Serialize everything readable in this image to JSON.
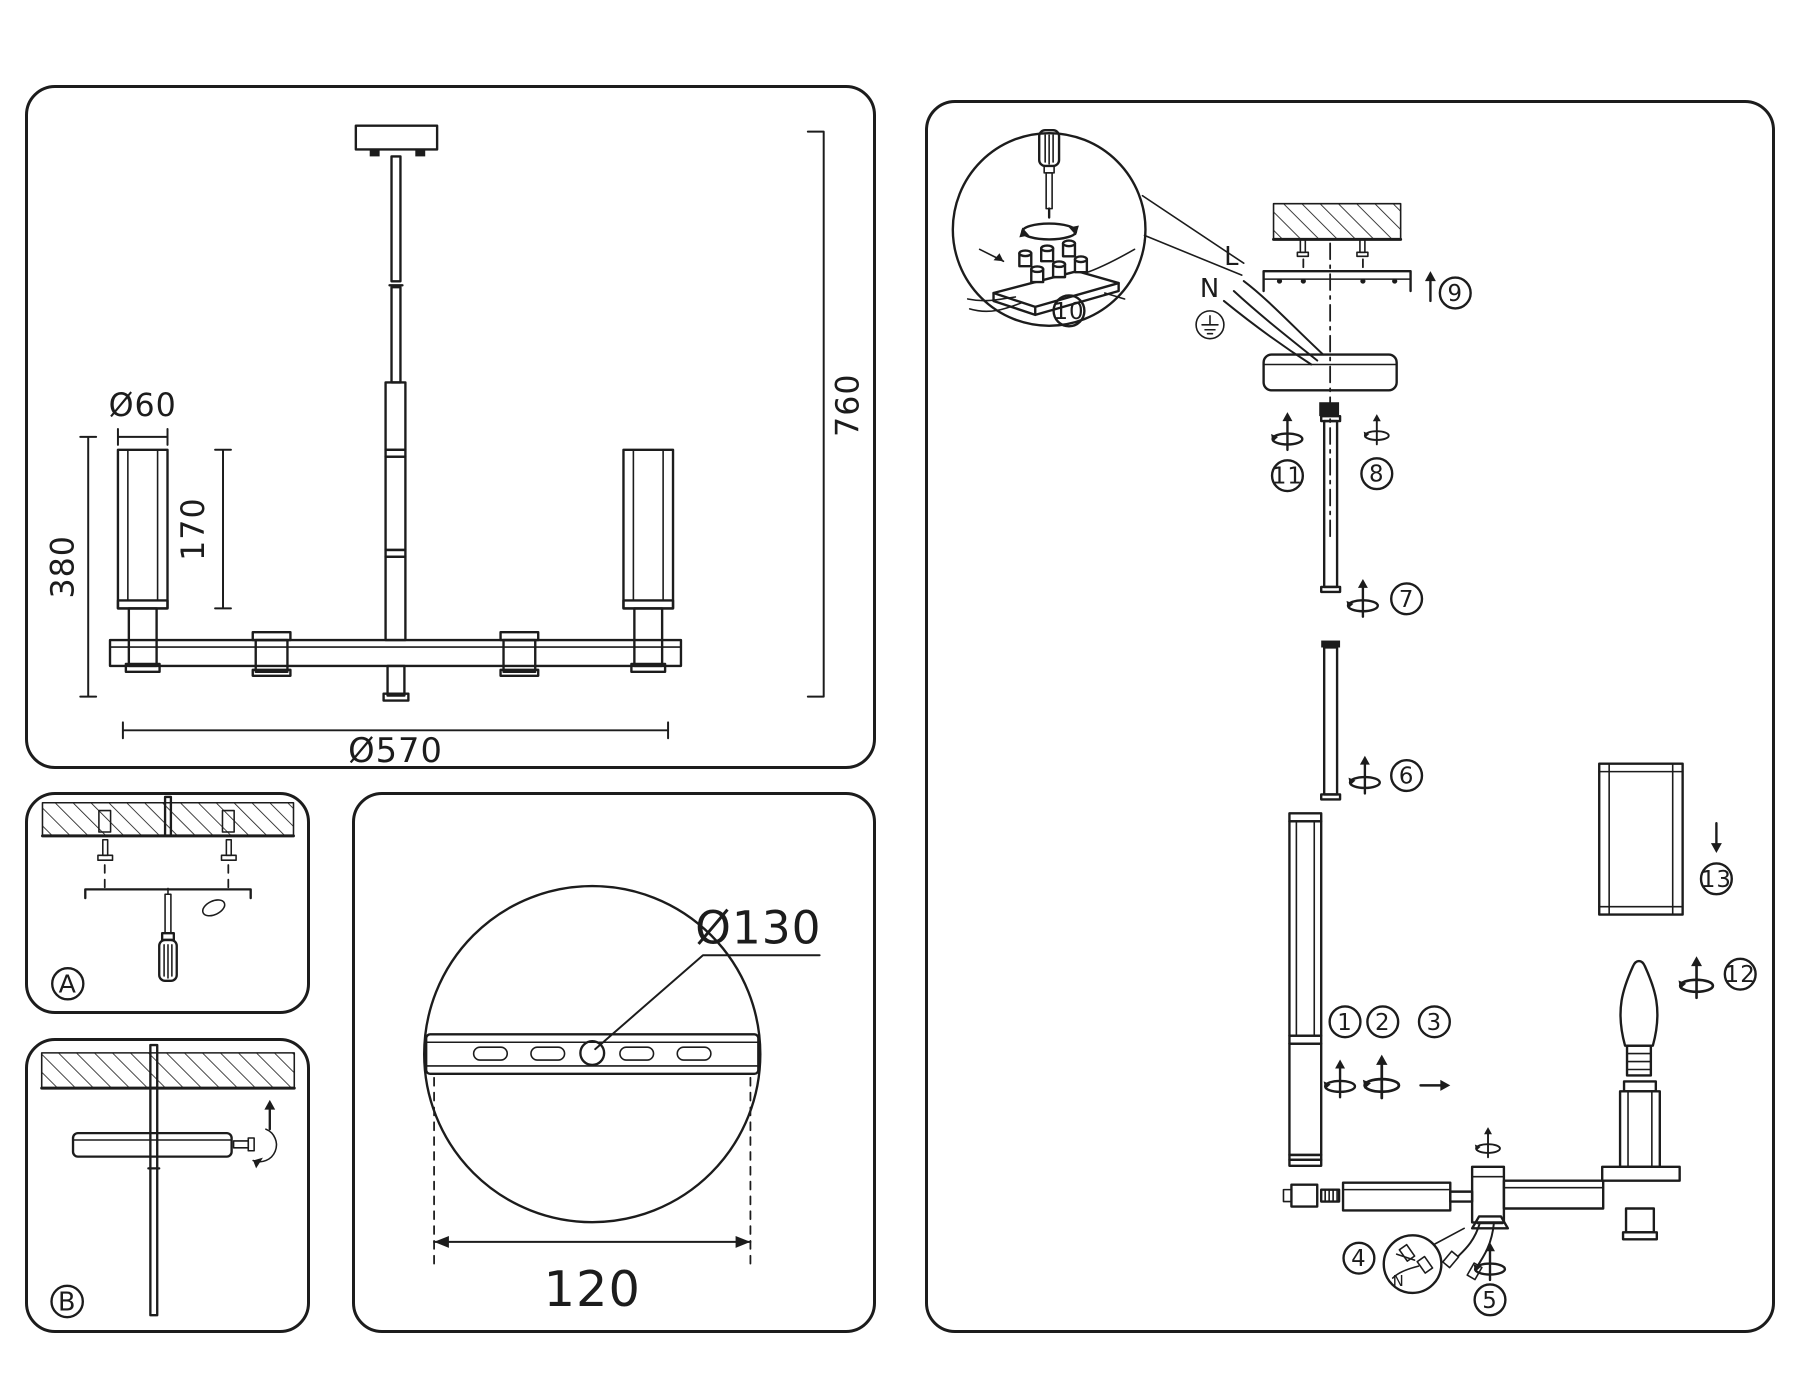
{
  "doc": {
    "background": "#ffffff",
    "line_color": "#1c1c1c"
  },
  "dims_panel": {
    "shade_diameter": "Ø60",
    "body_height": "380",
    "shade_height": "170",
    "total_drop": "760",
    "fixture_diameter": "Ø570"
  },
  "canopy_panel": {
    "plate_diameter": "Ø130",
    "hole_spacing": "120"
  },
  "step_panels": {
    "a_label": "A",
    "b_label": "B"
  },
  "assembly": {
    "wire_neutral": "N",
    "wire_live": "L",
    "wire_neutral_detail": "N",
    "ground_icon": "earth-ground-symbol",
    "steps": [
      "1",
      "2",
      "3",
      "4",
      "5",
      "6",
      "7",
      "8",
      "9",
      "10",
      "11",
      "12",
      "13"
    ]
  }
}
